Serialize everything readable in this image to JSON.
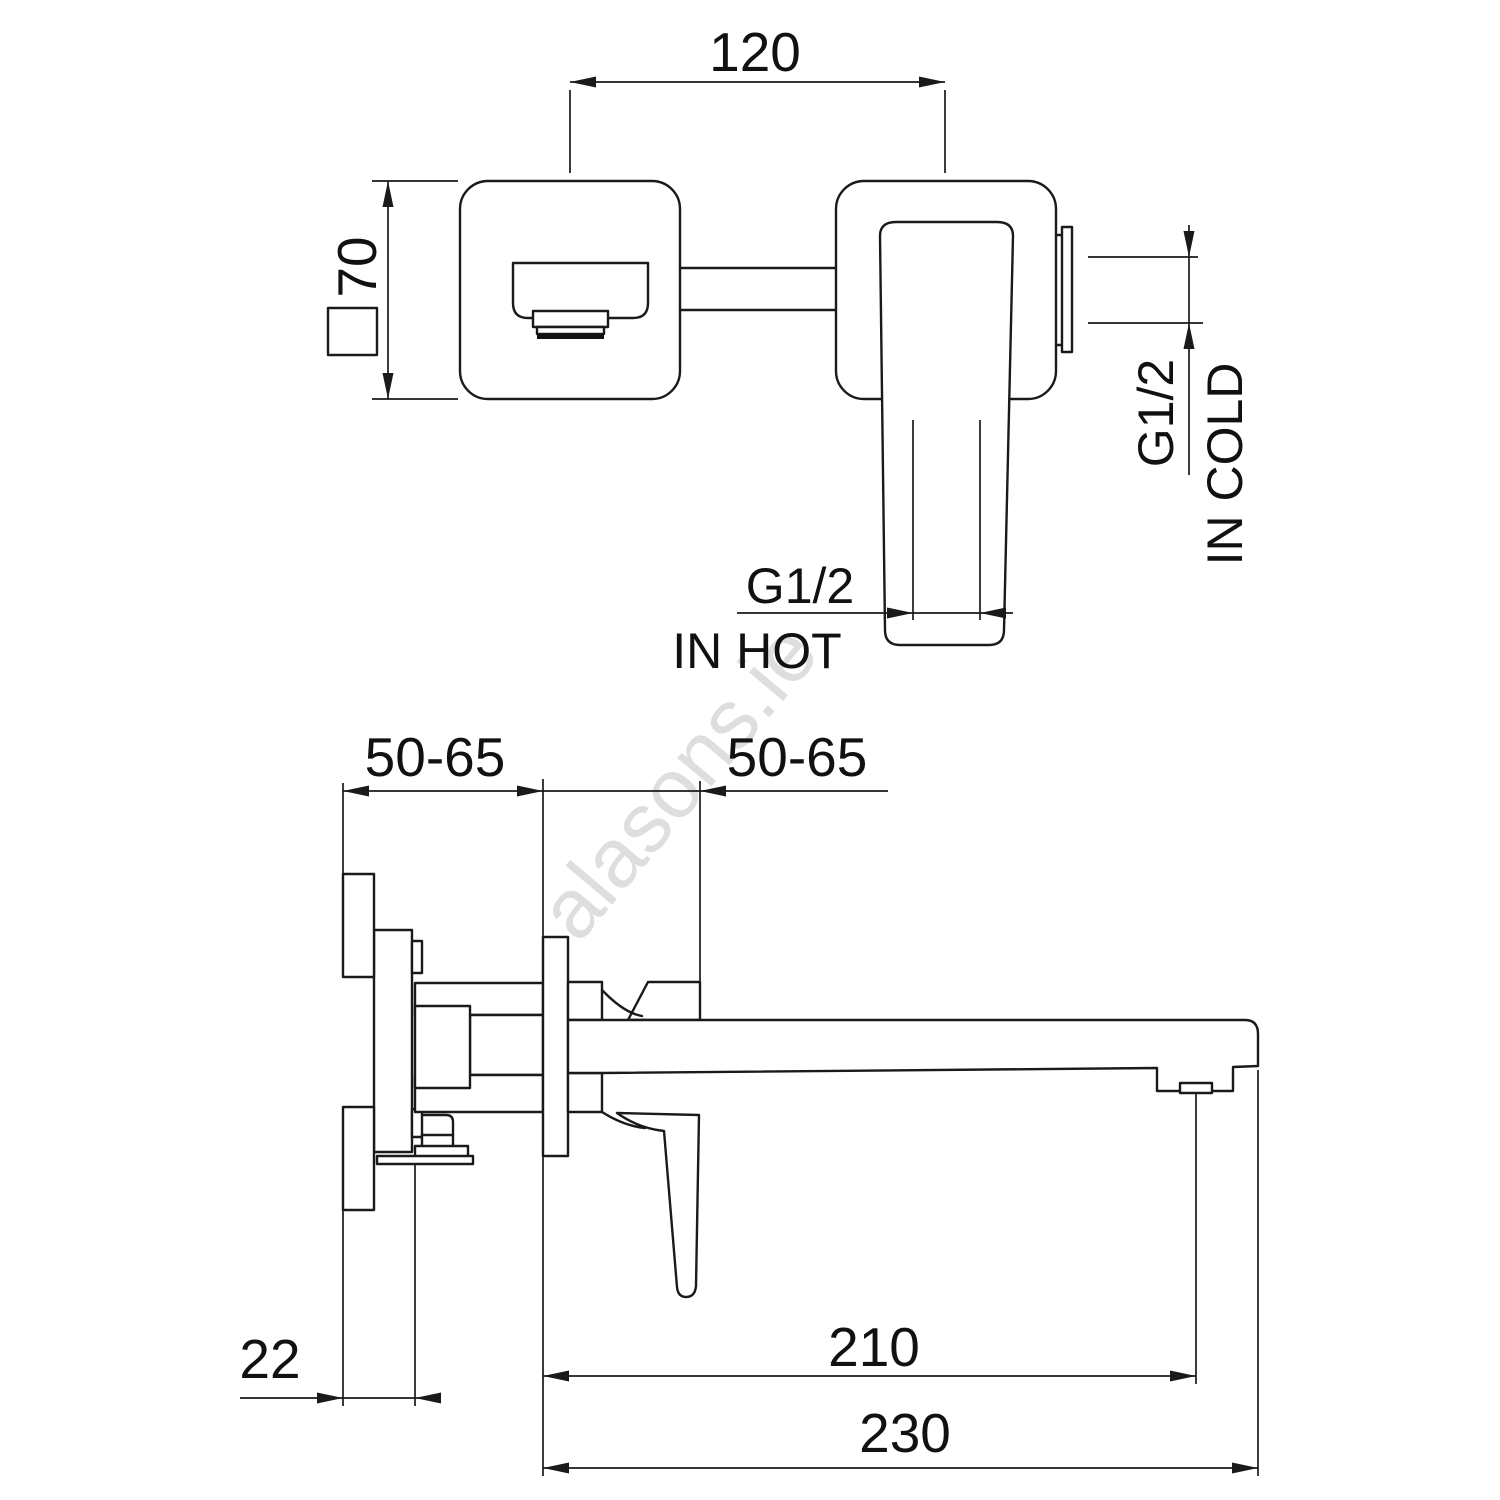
{
  "labels": {
    "plate_pitch": "120",
    "plate_size": "70",
    "hot_thread": "G1/2",
    "hot_inlet": "IN HOT",
    "cold_thread": "G1/2",
    "cold_inlet": "IN COLD",
    "rough_in_left": "50-65",
    "rough_in_right": "50-65",
    "plate_thickness": "22",
    "aerator_reach": "210",
    "spout_reach": "230"
  },
  "watermark": {
    "text": "alasons.ie"
  },
  "colors": {
    "line": "#1a1a1a",
    "text": "#111111",
    "watermark": "#c9c9c9",
    "background": "#ffffff"
  }
}
